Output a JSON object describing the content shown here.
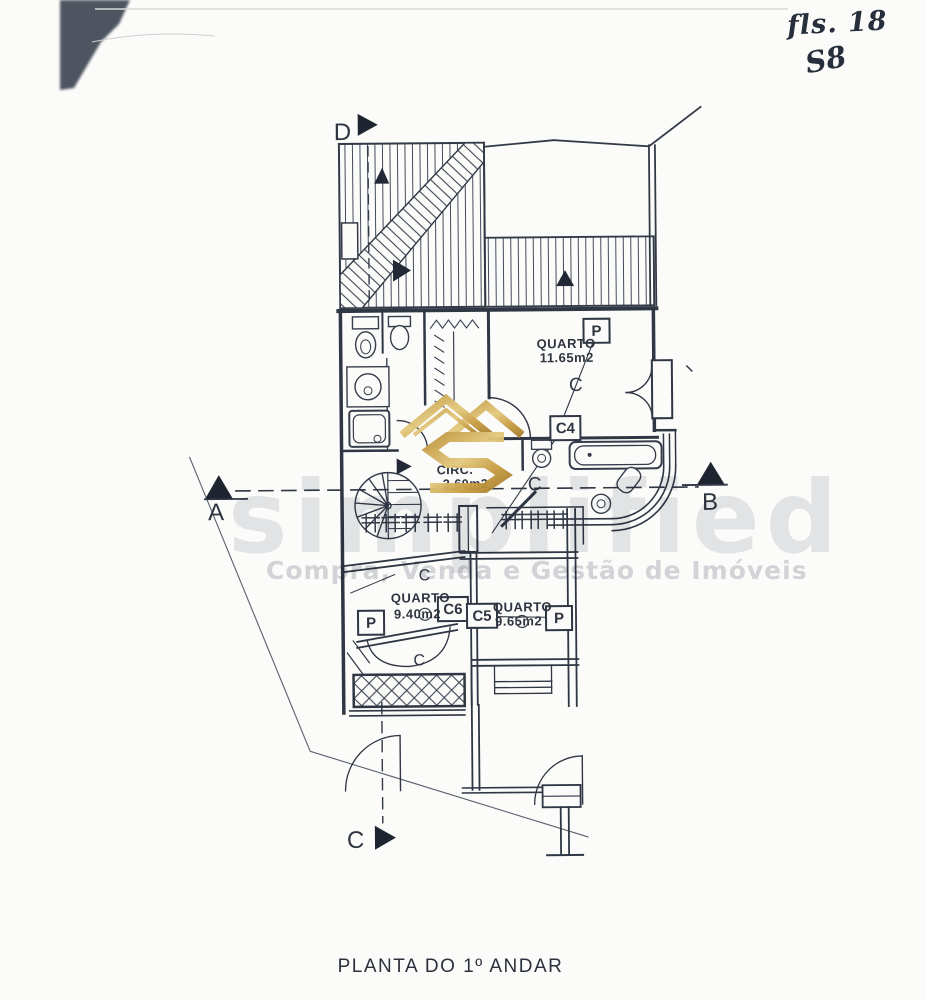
{
  "page": {
    "title": "PLANTA DO 1º ANDAR",
    "handwritten_note": {
      "line1": "fls. 18",
      "line2": "S8"
    }
  },
  "watermark": {
    "brand": "simplified",
    "tagline": "Compra, Venda e Gestão de Imóveis",
    "logo": "gold-double-roof-s-monogram",
    "gold_color": "#C79B43",
    "gray_color": "#C2C5CD"
  },
  "plan": {
    "rooms": {
      "bedroom1": {
        "label": "QUARTO",
        "area": "11.65m2"
      },
      "circulation": {
        "label": "CIRC.",
        "area": "3.60m2"
      },
      "bedroom2": {
        "label": "QUARTO",
        "area": "9.40m2"
      },
      "bedroom3": {
        "label": "QUARTO",
        "area": "9.65m2"
      }
    },
    "tags": {
      "door": "P",
      "c4": "C4",
      "c5": "C5",
      "c6": "C6",
      "closet": "C"
    },
    "section_markers": {
      "a": "A",
      "b": "B",
      "c": "C",
      "d": "D"
    }
  }
}
